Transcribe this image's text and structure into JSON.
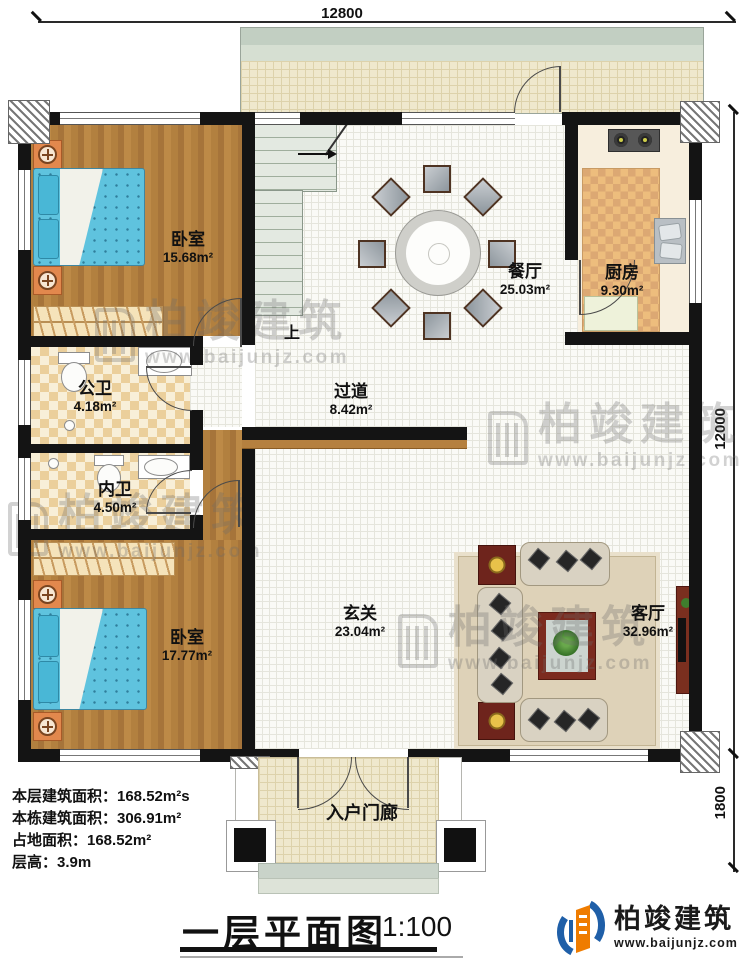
{
  "dims": {
    "top": "12800",
    "right_upper": "12000",
    "right_lower": "1800"
  },
  "rooms": {
    "bedroom1": {
      "name": "卧室",
      "area": "15.68m²"
    },
    "bath_public": {
      "name": "公卫",
      "area": "4.18m²"
    },
    "bath_private": {
      "name": "内卫",
      "area": "4.50m²"
    },
    "bedroom2": {
      "name": "卧室",
      "area": "17.77m²"
    },
    "dining": {
      "name": "餐厅",
      "area": "25.03m²"
    },
    "kitchen": {
      "name": "厨房",
      "area": "9.30m²"
    },
    "hallway": {
      "name": "过道",
      "area": "8.42m²"
    },
    "foyer": {
      "name": "玄关",
      "area": "23.04m²"
    },
    "living": {
      "name": "客厅",
      "area": "32.96m²"
    },
    "porch": {
      "name": "入户门廊"
    },
    "stairs": {
      "up_label": "上"
    }
  },
  "info": {
    "line1": "本层建筑面积：168.52m²s",
    "line2": "本栋建筑面积：306.91m²",
    "line3": "占地面积：168.52m²",
    "line4": "层高：3.9m"
  },
  "title": {
    "text": "一层平面图",
    "scale": "1:100"
  },
  "brand": {
    "name": "柏竣建筑",
    "site": "www.baijunjz.com"
  },
  "watermark": {
    "name": "柏竣建筑",
    "site": "www.baijunjz.com"
  },
  "colors": {
    "wall": "#141414",
    "wood": "#b2803f",
    "bed_blue": "#5fc3de",
    "bath_tile": "#ebcf9b",
    "brand_blue": "#1f5fa8",
    "brand_orange": "#ef7c00"
  }
}
